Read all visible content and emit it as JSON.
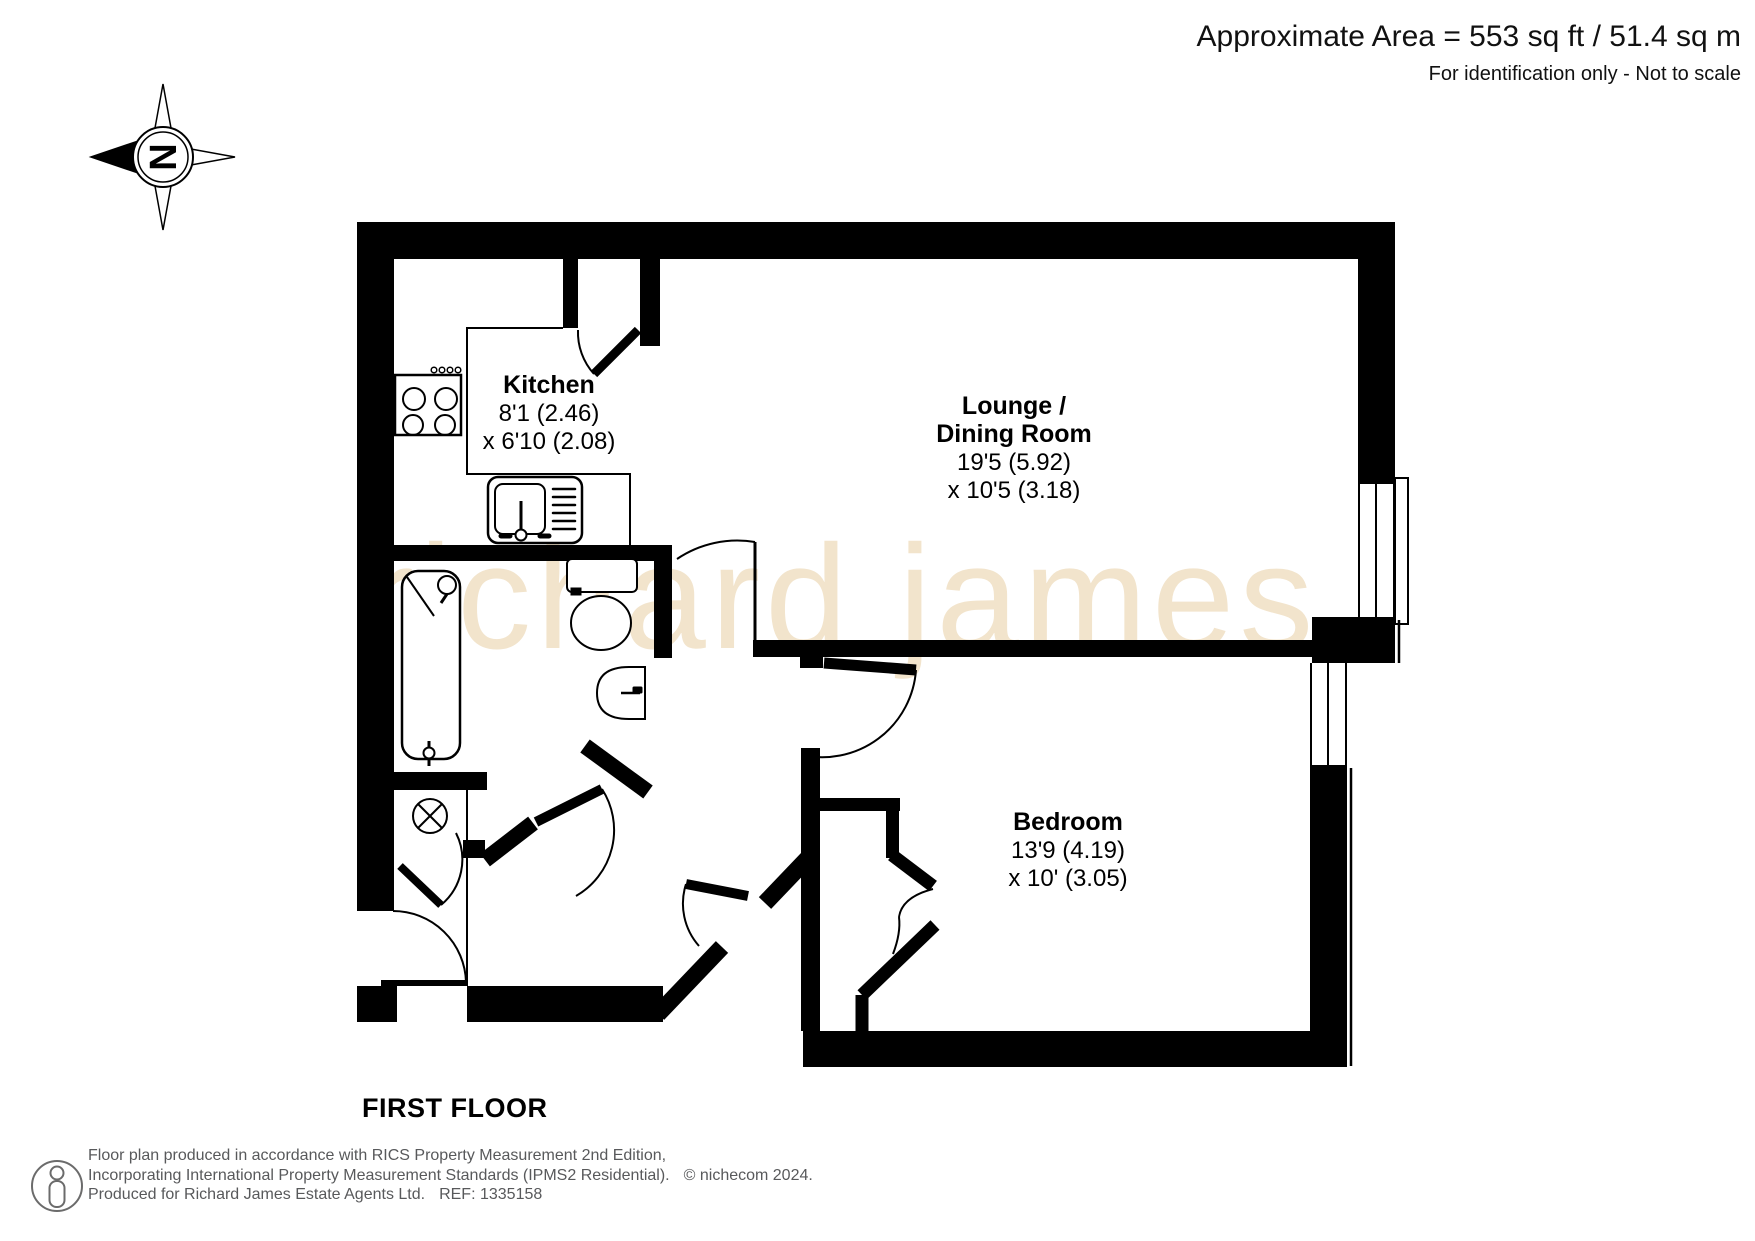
{
  "header": {
    "area": "Approximate Area = 553 sq ft / 51.4 sq m",
    "note": "For identification only - Not to scale"
  },
  "compass": {
    "letter": "N"
  },
  "watermark": {
    "text": "richard james"
  },
  "floor_label": "FIRST FLOOR",
  "rooms": {
    "kitchen": {
      "name": "Kitchen",
      "dim1": "8'1 (2.46)",
      "dim2": "x 6'10 (2.08)"
    },
    "lounge": {
      "name_line1": "Lounge /",
      "name_line2": "Dining Room",
      "dim1": "19'5 (5.92)",
      "dim2": "x 10'5 (3.18)"
    },
    "bedroom": {
      "name": "Bedroom",
      "dim1": "13'9 (4.19)",
      "dim2": "x 10' (3.05)"
    }
  },
  "footer": {
    "line1": "Floor plan produced in accordance with RICS Property Measurement 2nd Edition,",
    "line2": "Incorporating International Property Measurement Standards (IPMS2 Residential).",
    "copyright": "© nichecom 2024.",
    "line3": "Produced for Richard James Estate Agents Ltd.",
    "ref": "REF: 1335158"
  },
  "colors": {
    "wall": "#000000",
    "watermark": "#f2e4cc",
    "footer_text": "#58595b"
  }
}
